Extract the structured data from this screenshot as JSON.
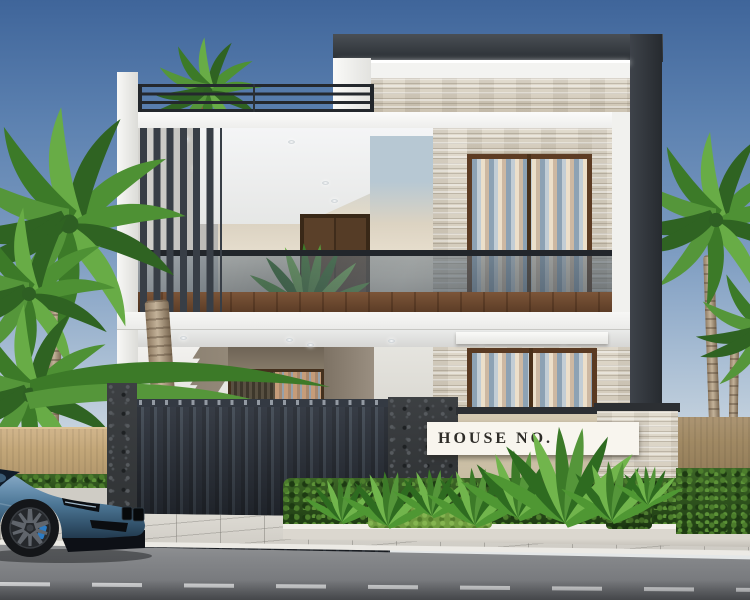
{
  "scene": {
    "type": "3d architectural exterior render",
    "subject": "Modern two-storey house with roof terrace, charcoal feature frame, travertine cladding, vertical louvers, glass balcony, dark slatted gate, tropical plants, palm trees and a blue sports coupe parked on the street"
  },
  "sign": {
    "text": "HOUSE NO."
  },
  "palette": {
    "sky_top": "#3F659A",
    "sky_horizon": "#E9EAE9",
    "facade_white": "#F4F4F2",
    "frame_charcoal": "#33383D",
    "travertine": "#D8D0C3",
    "wood_plank_brown": "#6B4731",
    "door_brown": "#4F3826",
    "gate_dark": "#2A303A",
    "boundary_wall_tan": "#C4A87C",
    "interior_taupe": "#877C6E",
    "panel_blue": "#B5C6D1",
    "panel_cream": "#E8E1D2",
    "glass_tint": "#64757F",
    "foliage_green": "#4F9632",
    "hedge_green": "#2D511E",
    "road_gray": "#8F9093",
    "sidewalk_gray": "#D8D5CE",
    "car_blue": "#53809F",
    "brake_caliper_blue": "#2D7BC2",
    "sign_background": "#F8F5EE",
    "sign_text_color": "#2E2C28",
    "led_strip": "#FFFFFF"
  },
  "objects": {
    "car": "blue sports coupe, front three-quarter view",
    "trees": "palm trees left, right and on roof terrace",
    "gate": "dark vertical-slat sliding gate with stone pillar",
    "plants": "tropical shrubs, lawn strip and box hedges in white planter",
    "road": "asphalt street with dashed white lane marking"
  }
}
